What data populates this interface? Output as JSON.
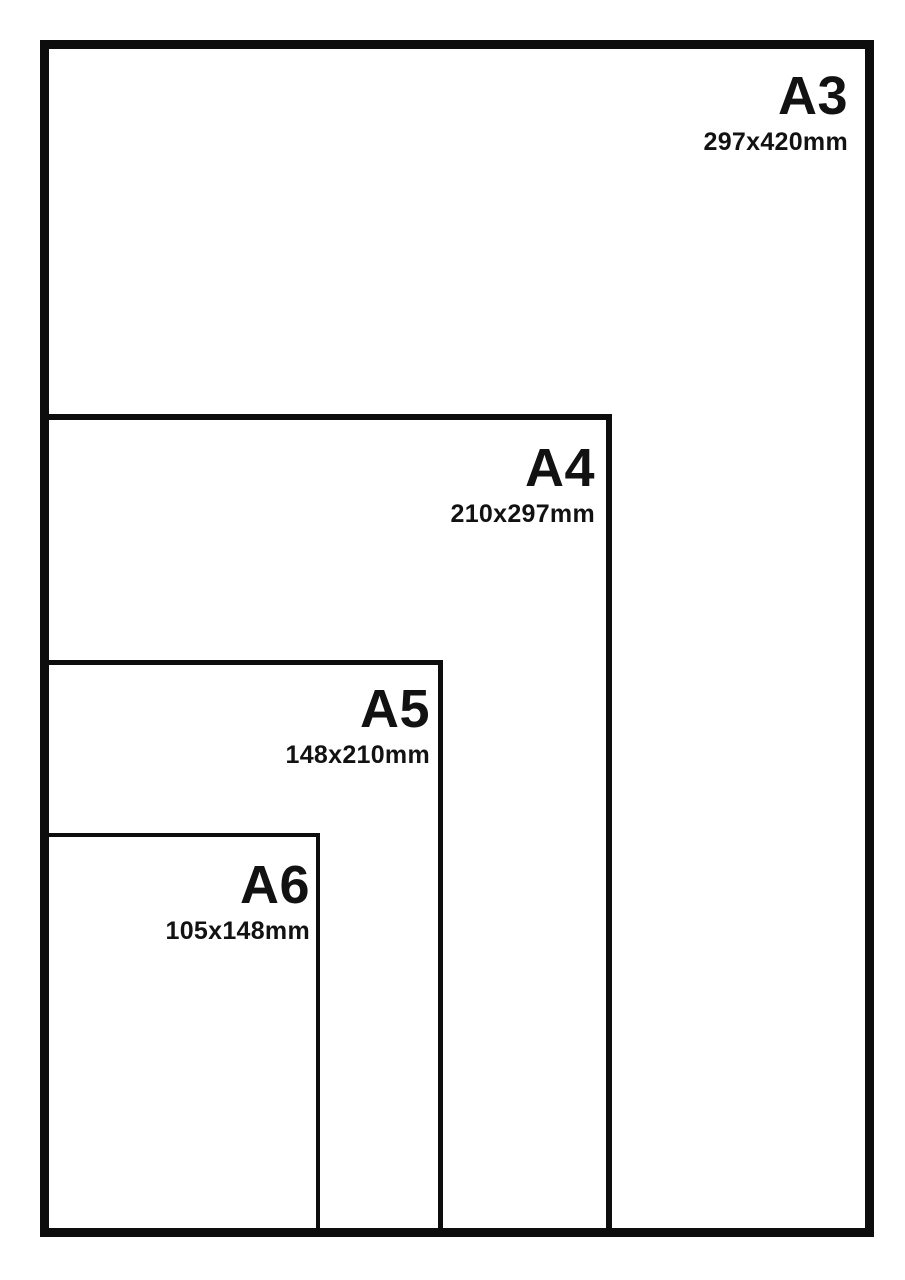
{
  "diagram": {
    "name": "paper-size-comparison",
    "sizes": [
      {
        "id": "a3",
        "label": "A3",
        "dimensions": "297x420mm"
      },
      {
        "id": "a4",
        "label": "A4",
        "dimensions": "210x297mm"
      },
      {
        "id": "a5",
        "label": "A5",
        "dimensions": "148x210mm"
      },
      {
        "id": "a6",
        "label": "A6",
        "dimensions": "105x148mm"
      }
    ],
    "colors": {
      "line": "#0d0d0d",
      "text": "#121212",
      "background": "#ffffff"
    }
  }
}
